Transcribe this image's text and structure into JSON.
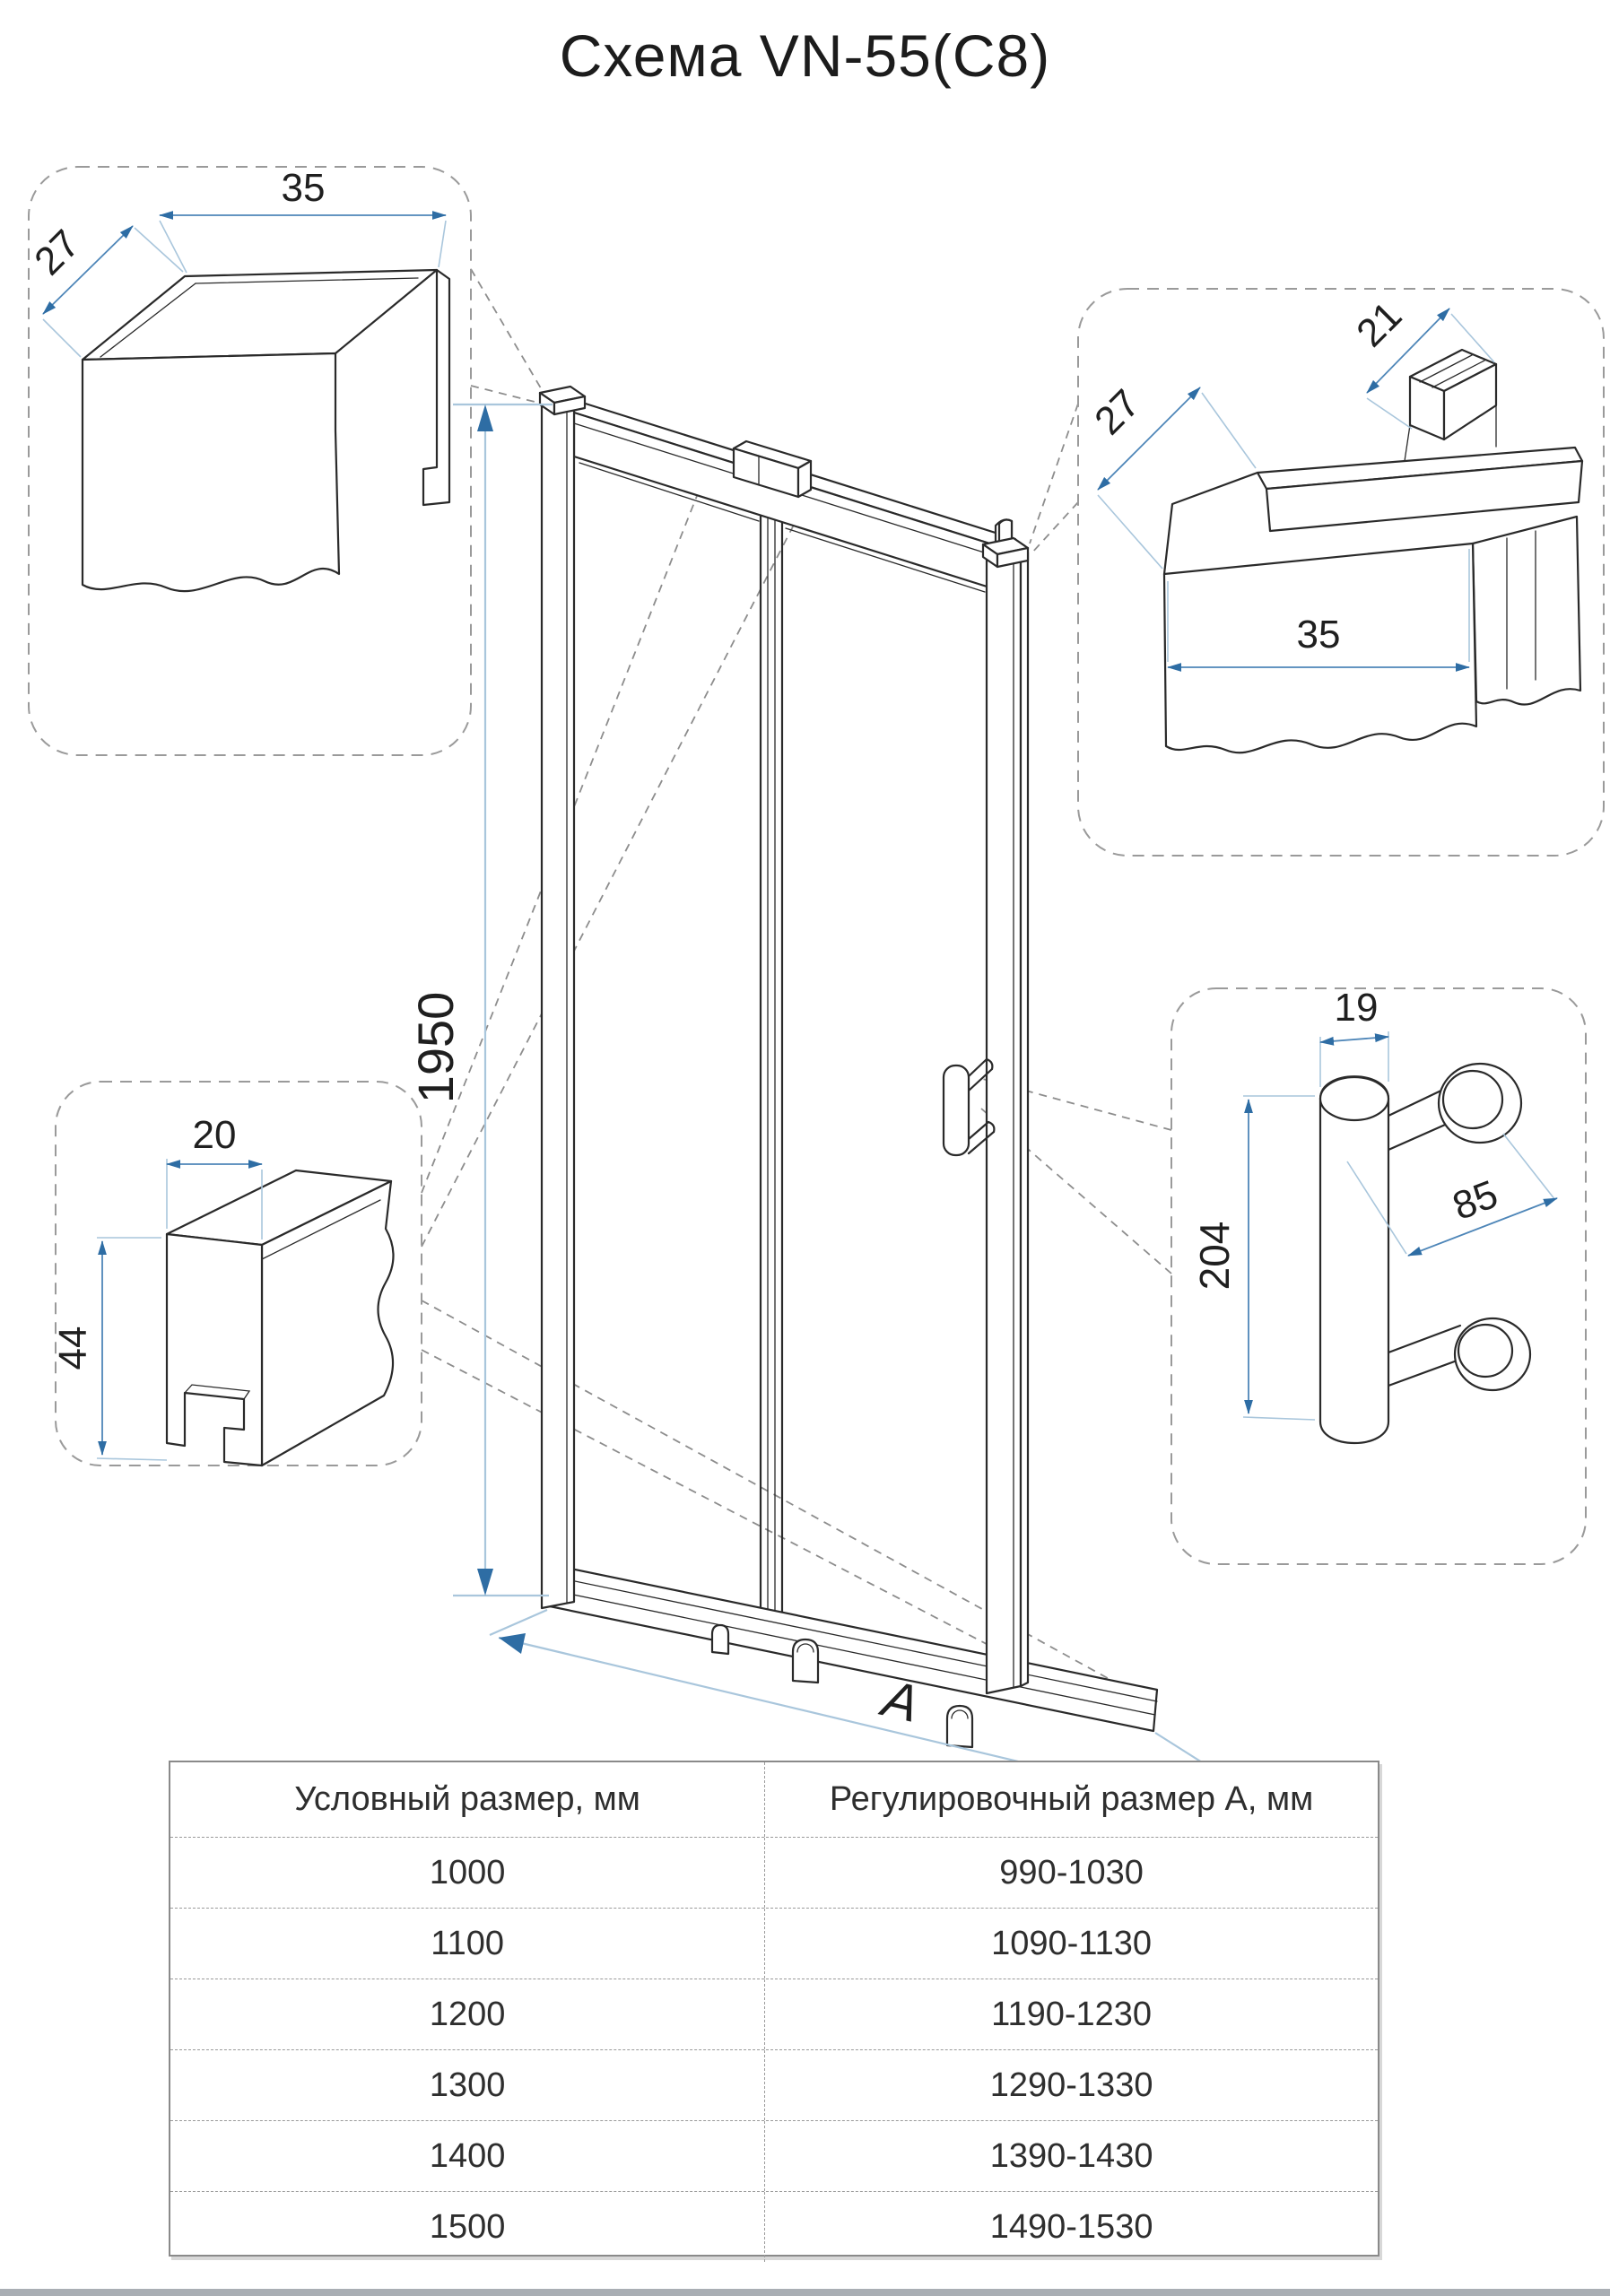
{
  "title": "Схема VN-55(C8)",
  "diagram": {
    "main_height_label": "1950",
    "width_label": "A",
    "callouts": {
      "top_left": {
        "dims": {
          "width": "35",
          "depth": "27"
        }
      },
      "top_right": {
        "dims": {
          "inner": "21",
          "depth": "27",
          "width": "35"
        }
      },
      "bottom_left": {
        "dims": {
          "width": "20",
          "height": "44"
        }
      },
      "handle": {
        "dims": {
          "diameter": "19",
          "length": "204",
          "spacing": "85"
        }
      }
    }
  },
  "table": {
    "headers": [
      "Условный размер, мм",
      "Регулировочный размер А, мм"
    ],
    "rows": [
      [
        "1000",
        "990-1030"
      ],
      [
        "1100",
        "1090-1130"
      ],
      [
        "1200",
        "1190-1230"
      ],
      [
        "1300",
        "1290-1330"
      ],
      [
        "1400",
        "1390-1430"
      ],
      [
        "1500",
        "1490-1530"
      ]
    ]
  },
  "colors": {
    "line": "#2a2a2a",
    "dimension": "#4e86b8",
    "extension": "#a9c6dc",
    "arrow": "#2e6da4",
    "callout_border": "#9a9a9a",
    "bottom_strip": "#a9aeb4"
  }
}
